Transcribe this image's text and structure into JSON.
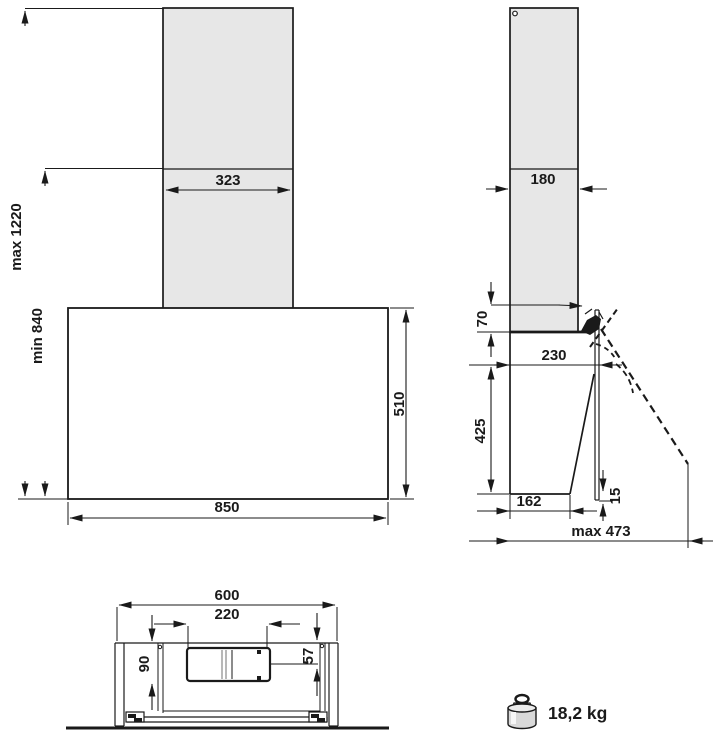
{
  "title": "cooker-hood-dimension-drawing",
  "colors": {
    "line": "#1a1a1a",
    "chimney_fill": "#e7e7e7",
    "body_fill": "#ffffff",
    "weight_fill": "#d9d9d9",
    "weight_top_fill": "#ececec"
  },
  "dims": {
    "front": {
      "chimney_width": "323",
      "height_max": "max 1220",
      "height_min": "min 840",
      "body_height": "510",
      "body_width": "850"
    },
    "side": {
      "chimney_depth": "180",
      "top_offset": "70",
      "body_depth": "230",
      "front_height": "425",
      "bottom_depth": "162",
      "panel_offset": "15",
      "open_depth": "max 473"
    },
    "bottom": {
      "overall_width": "600",
      "duct_width": "220",
      "duct_depth": "90",
      "duct_center": "57"
    },
    "weight": "18,2 kg"
  }
}
